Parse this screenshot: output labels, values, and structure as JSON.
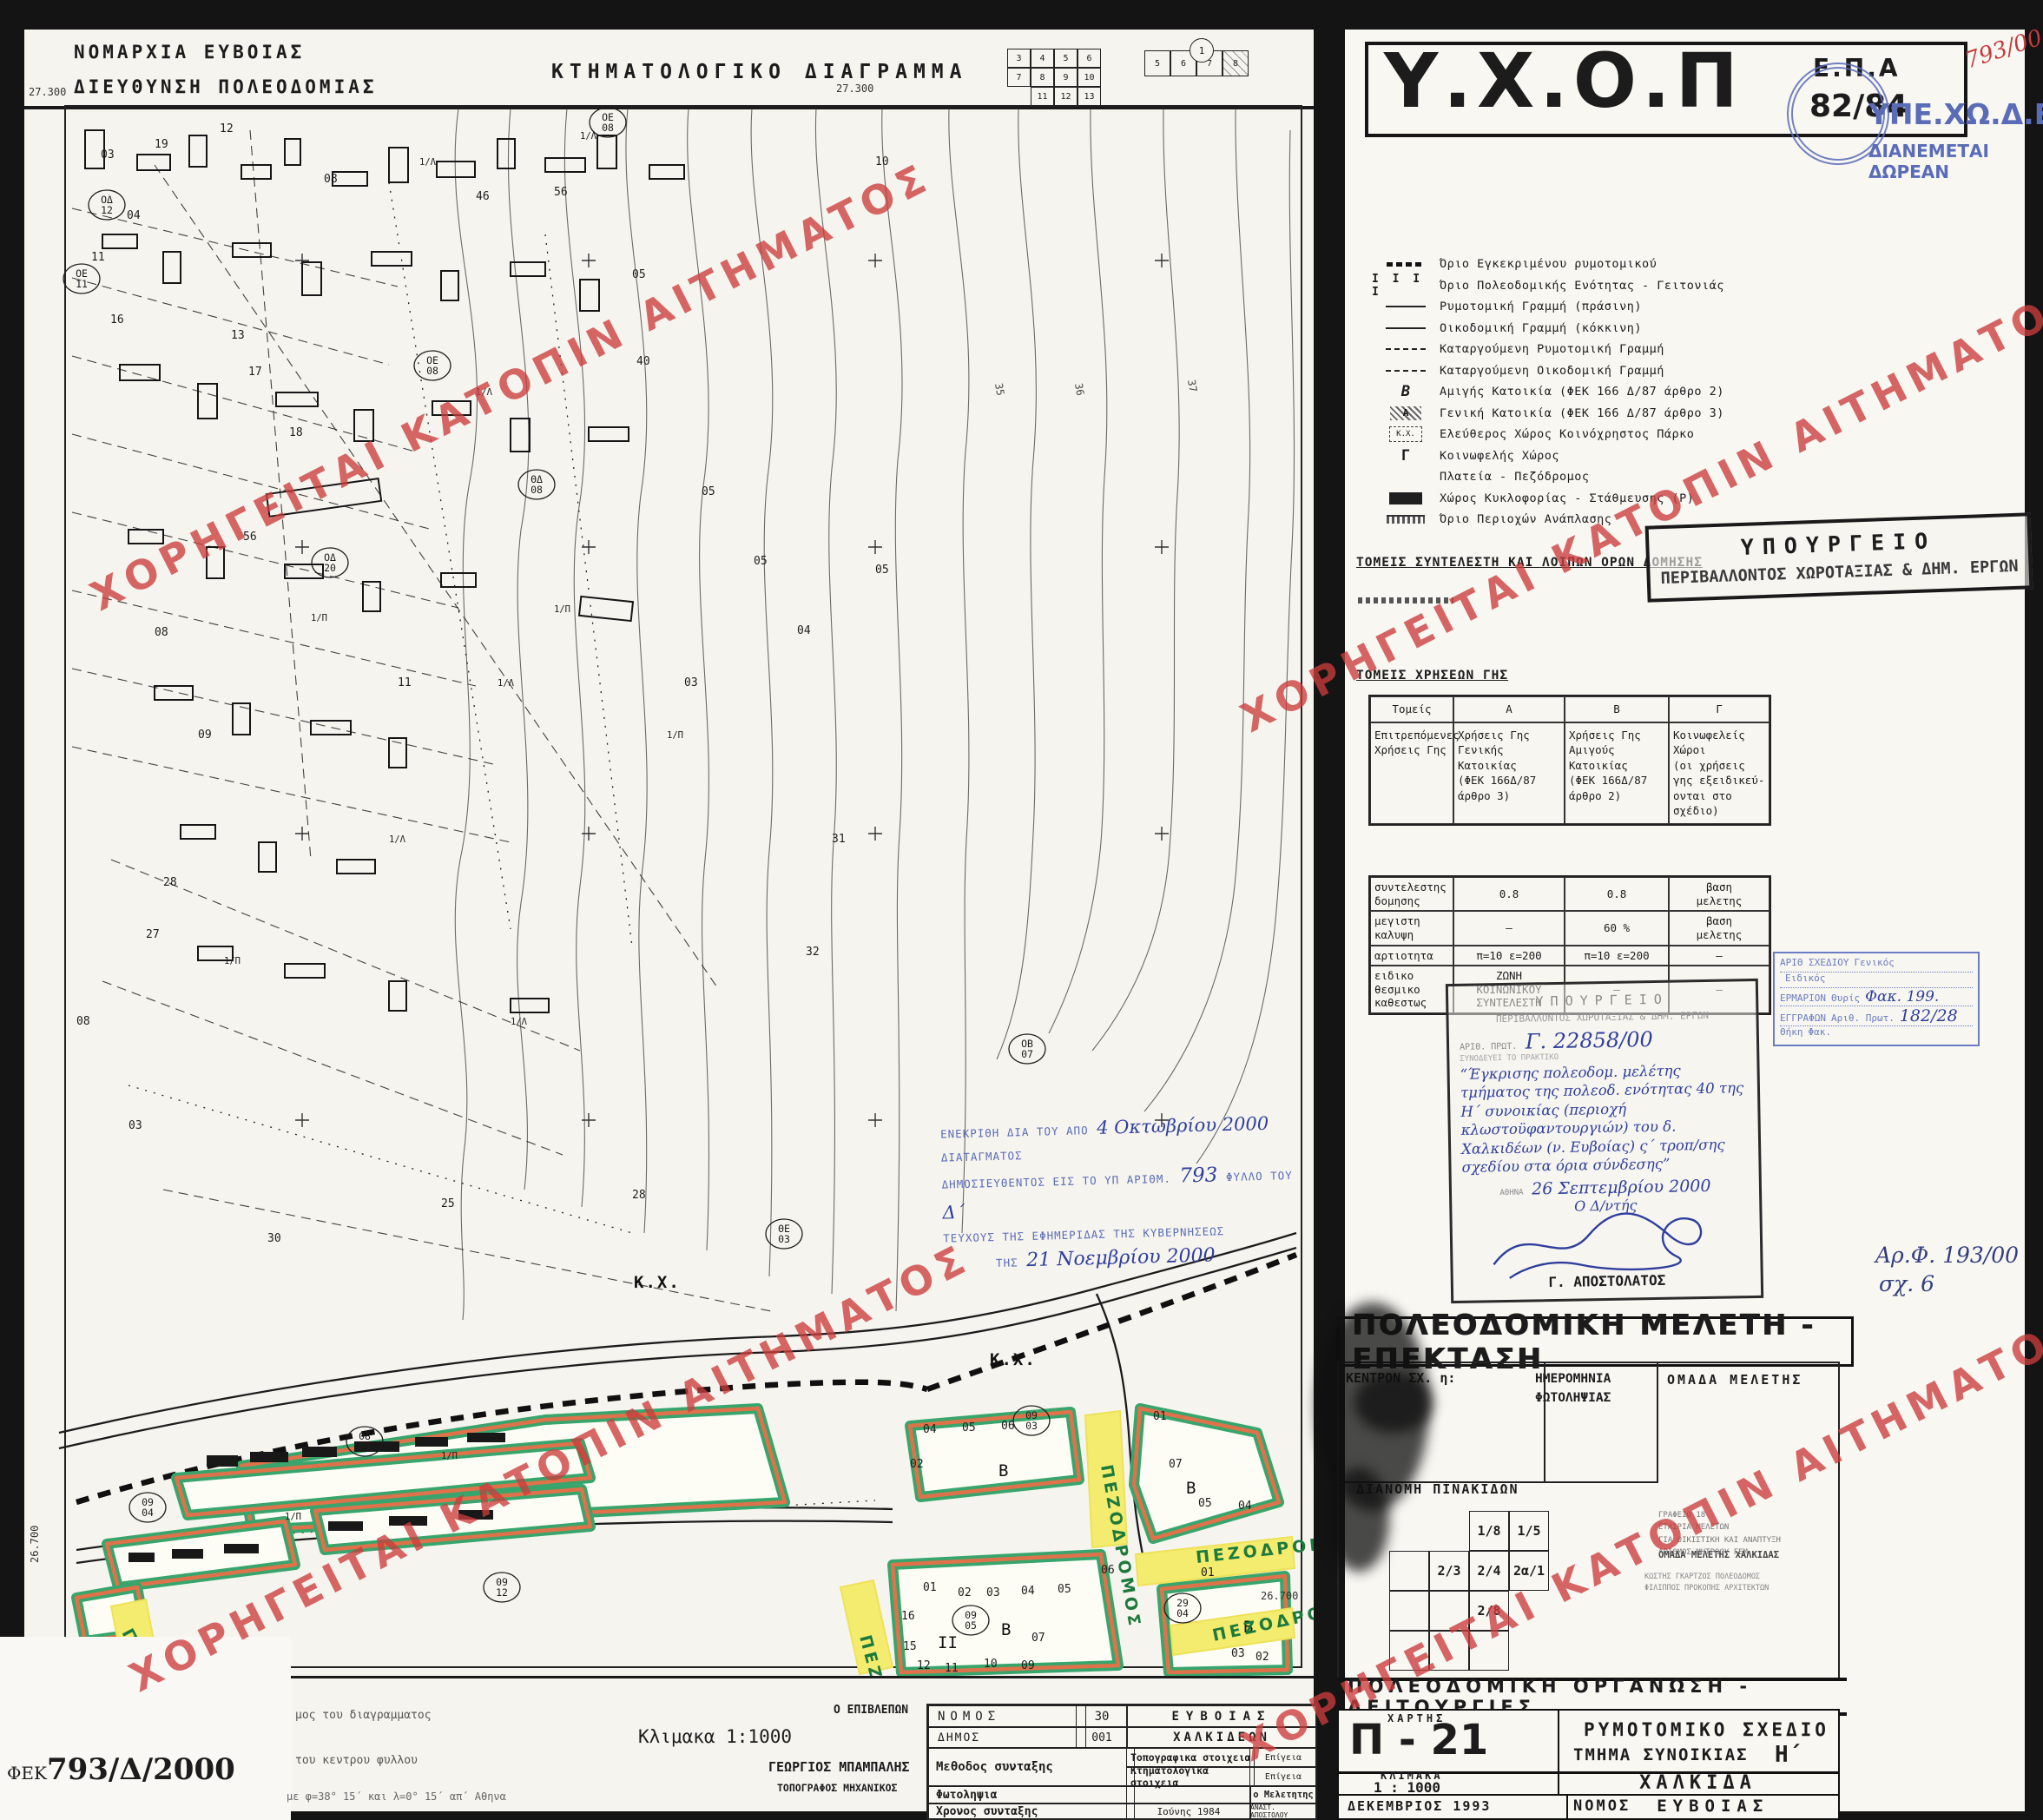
{
  "header": {
    "line1": "ΝΟΜΑΡΧΙΑ ΕΥΒΟΙΑΣ",
    "line2": "ΔΙΕΥΘΥΝΣΗ ΠΟΛΕΟΔΟΜΙΑΣ",
    "title": "ΚΤΗΜΑΤΟΛΟΓΙΚΟ ΔΙΑΓΡΑΜΜΑ"
  },
  "index_grids": {
    "left": [
      [
        "3",
        "4",
        "5",
        "6"
      ],
      [
        "7",
        "8",
        "9",
        "10"
      ],
      [
        "",
        "11",
        "12",
        "13"
      ]
    ],
    "right_top": "1",
    "right_row": [
      "5",
      "6",
      "7",
      "8"
    ]
  },
  "agency": {
    "name": "Υ.Χ.Ο.Π",
    "epa": "Ε.Π.Α",
    "code": "82/84",
    "dept": "ΥΠΕ.ΧΩ.Δ.Ε.",
    "free": "ΔΙΑΝΕΜΕΤΑΙ ΔΩΡΕΑΝ",
    "note_red": "793/00"
  },
  "legend": {
    "items": [
      "Όριο Εγκεκριμένου ρυμοτομικού",
      "Όριο Πολεοδομικής Ενότητας - Γειτονιάς",
      "Ρυμοτομική Γραμμή (πράσινη)",
      "Οικοδομική Γραμμή (κόκκινη)",
      "Καταργούμενη Ρυμοτομική Γραμμή",
      "Καταργούμενη Οικοδομική Γραμμή",
      "Αμιγής Κατοικία (ΦΕΚ 166 Δ/87 άρθρο 2)",
      "Γενική Κατοικία (ΦΕΚ 166 Δ/87 άρθρο 3)",
      "Ελεύθερος Χώρος Κοινόχρηστος   Πάρκο",
      "Κοινωφελής Χώρος",
      "Πλατεία - Πεζόδρομος",
      "Χώρος Κυκλοφορίας - Στάθμευσης (Ρ)",
      "Όριο Περιοχών Ανάπλασης"
    ]
  },
  "sections": {
    "coeff_heading": "ΤΟΜΕΙΣ ΣΥΝΤΕΛΕΣΤΗ ΚΑΙ ΛΟΙΠΩΝ ΟΡΩΝ ΔΟΜΗΣΗΣ",
    "landuse_heading": "ΤΟΜΕΙΣ ΧΡΗΣΕΩΝ ΓΗΣ"
  },
  "ministry_box": {
    "l1": "ΥΠΟΥΡΓΕΙΟ",
    "l2": "ΠΕΡΙΒΑΛΛΟΝΤΟΣ ΧΩΡΟΤΑΞΙΑΣ & ΔΗΜ. ΕΡΓΩΝ"
  },
  "landuse_table": {
    "headers": [
      "Τομείς",
      "Α",
      "Β",
      "Γ"
    ],
    "row_label": "Επιτρεπόμενες\nΧρήσεις Γης",
    "col_a": "Χρήσεις Γης\nΓενικής\nΚατοικίας\n(ΦΕΚ 166Δ/87\nάρθρο 3)",
    "col_b": "Χρήσεις Γης\nΑμιγούς\nΚατοικίας\n(ΦΕΚ 166Δ/87\nάρθρο 2)",
    "col_c": "Κοινωφελείς\nΧώροι\n(οι χρήσεις\nγης εξειδικεύ-\nονται στο σχέδιο)"
  },
  "coeff_table": {
    "rows": [
      {
        "label": "συντελεστης\nδομησης",
        "a": "0.8",
        "b": "0.8",
        "c": "βαση\nμελετης"
      },
      {
        "label": "μεγιστη\nκαλυψη",
        "a": "–",
        "b": "60 %",
        "c": "βαση\nμελετης"
      },
      {
        "label": "αρτιοτητα",
        "a": "π=10  ε=200",
        "b": "π=10  ε=200",
        "c": "—"
      },
      {
        "label": "ειδικο\nθεσμικο\nκαθεστως",
        "a": "ΖΩΝΗ\nΚΟΙΝΩΝΙΚΟΥ\nΣΥΝΤΕΛΕΣΤΗ",
        "b": "—",
        "c": "—"
      }
    ]
  },
  "approval_stamp": {
    "l1": "ΥΠΟΥΡΓΕΙΟ",
    "l2": "ΠΕΡΙΒΑΛΛΟΝΤΟΣ ΧΩΡΟΤΑΞΙΑΣ & ΔΗΜ. ΕΡΓΩΝ",
    "proto_label": "ΑΡΙΘ. ΠΡΩΤ.",
    "proto": "Γ. 22858/00",
    "attach_label": "ΣΥΝΟΔΕΥΕΙ ΤΟ ΠΡΑΚΤΙΚΟ",
    "subject": "“Έγκρισης πολεοδομ. μελέτης τμήματος της πολεοδ. ενότητας 40 της Η΄ συνοικίας (περιοχή κλωστοϋφαντουργιών) του δ. Χαλκιδέων (ν. Ευβοίας) ς΄ τροπ/σης σχεδίου στα όρια σύνδεσης”",
    "place": "ΑΘΗΝΑ",
    "date": "26 Σεπτεμβρίου 2000",
    "role": "Ο Δ/ντής",
    "signer": "Γ. ΑΠΟΣΤΟΛΑΤΟΣ"
  },
  "archive_stamp": {
    "r1l": "ΑΡΙΘ ΣΧΕΔΙΟΥ",
    "r1a": "Γενικός",
    "r1b": "Ειδικός",
    "r2l": "ΕΡΜΑΡΙΟΝ",
    "r2a": "Θυρίς",
    "r2b": "Φακ. 199.",
    "r3l": "ΕΓΓΡΑΦΩΝ",
    "r3a": "Αριθ. Πρωτ.",
    "r3b": "182/28",
    "r4a": "Θήκη",
    "r4b": "Φακ."
  },
  "file_note": {
    "l1": "Αρ.Φ. 193/00",
    "l2": "σχ. 6"
  },
  "study": {
    "title": "ΠΟΛΕΟΔΟΜΙΚΗ ΜΕΛΕΤΗ - ΕΠΕΚΤΑΣΗ",
    "c1": "ΚΕΝΤΡΟΝ ΣΧ. η:",
    "c2": "ΗΜΕΡΟΜΗΝΙΑ ΦΩΤΟΛΗΨΙΑΣ",
    "c3": "ΟΜΑΔΑ ΜΕΛΕΤΗΣ",
    "dist": "ΔΙΑΝΟΜΗ ΠΙΝΑΚΙΔΩΝ",
    "grid": [
      "1/8",
      "1/5",
      "2/3",
      "2/4",
      "2α/1",
      "2/8"
    ],
    "team": "ΟΜΑΔΑ ΜΕΛΕΤΗΣ ΧΑΛΚΙΔΑΣ",
    "firm": "ΓΡΑΦΕΙΟ 18\nΕΤΑΙΡΙΑ ΜΕΛΕΤΩΝ\nΓΙΑ ΟΙΚΙΣΤΙΚΗ ΚΑΙ ΑΝΑΠΤΥΞΗ\nΑΡΙΘΜΟΣ ΜΗΤΡΩΟΥ ΓΕΜ",
    "names": "ΚΩΣΤΗΣ ΓΚΑΡΤΖΟΣ   ΠΟΛΕΟΔΟΜΟΣ\nΦΙΛΙΠΠΟΣ ΠΡΟΚΟΠΗΣ   ΑΡΧΙΤΕΚΤΩΝ"
  },
  "org_bar": "ΠΟΛΕΟΔΟΜΙΚΗ ΟΡΓΑΝΩΣΗ - ΛΕΙΤΟΥΡΓΙΕΣ",
  "titleblock": {
    "map_label": "ΧΑΡΤΗΣ",
    "code": "Π - 21",
    "plan1": "ΡΥΜΟΤΟΜΙΚΟ ΣΧΕΔΙΟ",
    "plan2": "ΤΜΗΜΑ ΣΥΝΟΙΚΙΑΣ",
    "plan2v": "Η΄",
    "scale_label": "ΚΛΙΜΑΚΑ",
    "scale": "1 : 1000",
    "city": "ΧΑΛΚΙΔΑ",
    "date": "ΔΕΚΕΜΒΡΙΟΣ 1993",
    "nomos_label": "ΝΟΜΟΣ",
    "nomos": "ΕΥΒΟΙΑΣ"
  },
  "corner": {
    "sheet": "Β4",
    "fek_label": "ΦΕΚ",
    "fek": "793/Δ/2000",
    "note1": "μος του διαγραμματος",
    "note2": "του κεντρου φυλλου",
    "note3": "με φ=38° 15΄ και λ=0° 15΄ απ΄ Αθηνα"
  },
  "supervisor": {
    "scale_note": "Κλιμακα  1:1000",
    "label": "Ο ΕΠΙΒΛΕΠΩΝ",
    "name": "ΓΕΩΡΓΙΟΣ  ΜΠΑΜΠΑΛΗΣ",
    "title": "ΤΟΠΟΓΡΑΦΟΣ  ΜΗΧΑΝΙΚΟΣ"
  },
  "survey": {
    "nomos_label": "ΝΟΜΟΣ",
    "nomos_code": "30",
    "nomos": "ΕΥΒΟΙΑΣ",
    "dimos_label": "ΔΗΜΟΣ",
    "dimos_code": "001",
    "dimos": "ΧΑΛΚΙΔΕΩΝ",
    "method_label": "Μεθοδος συνταξης",
    "topo_label": "Τοπογραφικα στοιχεια",
    "topo_val": "Επίγεια",
    "ktim_label": "Κτηματολογικα στοιχεια",
    "ktim_val": "Επίγεια",
    "photo_label": "Φωτοληψια",
    "meletitis": "ο Μελετητης",
    "time_label": "Χρονος συνταξης",
    "time_val": "Ιούνης  1984",
    "meletitis_name": "ΑΝΑΣΤ. ΑΠΟΣΤΟΛΟΥ"
  },
  "map": {
    "watermark": "ΧΟΡΗΓΕΙΤΑΙ ΚΑΤΟΠΙΝ ΑΙΤΗΜΑΤΟΣ",
    "stamp": {
      "p1": "ΕΝΕΚΡΙΘΗ ΔΙΑ ΤΟΥ ΑΠΟ",
      "h1": "4 Οκτωβρίου 2000",
      "p2": "ΔΙΑΤΑΓΜΑΤΟΣ",
      "p3": "ΔΗΜΟΣΙΕΥΘΕΝΤΟΣ ΕΙΣ ΤΟ ΥΠ ΑΡΙΘΜ.",
      "h2": "793",
      "p4": "ΦΥΛΛΟ ΤΟΥ",
      "h3": "Δ΄",
      "p5": "ΤΕΥΧΟΥΣ ΤΗΣ ΕΦΗΜΕΡΙΔΑΣ ΤΗΣ ΚΥΒΕΡΝΗΣΕΩΣ",
      "p6": "ΤΗΣ",
      "h4": "21 Νοεμβρίου 2000"
    },
    "labels": [
      [
        5,
        20,
        "27.300",
        "o",
        0
      ],
      [
        935,
        16,
        "27.300",
        "o",
        0
      ],
      [
        1424,
        1752,
        "26.700",
        "o",
        0
      ],
      [
        16,
        1710,
        "26.700",
        "o",
        -90
      ],
      [
        1118,
        352,
        "35",
        "t",
        80
      ],
      [
        1210,
        352,
        "36",
        "t",
        80
      ],
      [
        1340,
        348,
        "37",
        "t",
        80
      ],
      [
        1112,
        1482,
        "Κ.Χ.",
        "k",
        0
      ],
      [
        702,
        1393,
        "Κ.Χ.",
        "k",
        0
      ],
      [
        1122,
        1610,
        "Β",
        "B",
        0
      ],
      [
        1338,
        1630,
        "Β",
        "B",
        0
      ],
      [
        1125,
        1793,
        "Β",
        "B",
        0
      ],
      [
        1404,
        1790,
        "Β",
        "B",
        0
      ],
      [
        1052,
        1808,
        "II",
        "B",
        0
      ],
      [
        1240,
        1598,
        "ΠΕΖΟΔΡΟΜΟΣ",
        "p",
        80
      ],
      [
        1350,
        1710,
        "ΠΕΖΟΔΡΟΜΟΣ",
        "p",
        -6
      ],
      [
        962,
        1795,
        "ΠΕΖΟΔΡΟΜΟΣ",
        "p",
        75
      ],
      [
        1370,
        1800,
        "ΠΕΖΟΔΡΟΜΟΣ",
        "p",
        -12
      ],
      [
        112,
        1790,
        "ΠΕΖΟΔΡΟΜΟΣ",
        "p",
        62
      ],
      [
        95,
        150,
        "ΟΔ|12",
        "c",
        0
      ],
      [
        66,
        235,
        "ΟΕ|11",
        "c",
        0
      ],
      [
        352,
        562,
        "ΟΔ|20",
        "c",
        0
      ],
      [
        470,
        335,
        "ΟΕ|08",
        "c",
        0
      ],
      [
        672,
        55,
        "ΟΕ|08",
        "c",
        0
      ],
      [
        590,
        472,
        "ΘΔ|08",
        "c",
        0
      ],
      [
        1155,
        1122,
        "ΟΒ|07",
        "c",
        0
      ],
      [
        875,
        1335,
        "ΘΕ|03",
        "c",
        0
      ],
      [
        142,
        1650,
        "09|04",
        "c",
        0
      ],
      [
        392,
        1574,
        "08|03",
        "c",
        0
      ],
      [
        1160,
        1550,
        "09|03",
        "c",
        0
      ],
      [
        1090,
        1780,
        "09|05",
        "c",
        0
      ],
      [
        1334,
        1766,
        "29|04",
        "c",
        0
      ],
      [
        550,
        1742,
        "09|12",
        "c",
        0
      ],
      [
        88,
        92,
        "03",
        "n",
        0
      ],
      [
        150,
        80,
        "19",
        "n",
        0
      ],
      [
        225,
        62,
        "12",
        "n",
        0
      ],
      [
        118,
        162,
        "04",
        "n",
        0
      ],
      [
        77,
        210,
        "11",
        "n",
        0
      ],
      [
        99,
        282,
        "16",
        "n",
        0
      ],
      [
        238,
        300,
        "13",
        "n",
        0
      ],
      [
        258,
        342,
        "17",
        "n",
        0
      ],
      [
        305,
        412,
        "18",
        "n",
        0
      ],
      [
        252,
        532,
        "56",
        "n",
        0
      ],
      [
        150,
        642,
        "08",
        "n",
        0
      ],
      [
        345,
        120,
        "08",
        "n",
        0
      ],
      [
        520,
        140,
        "46",
        "n",
        0
      ],
      [
        610,
        135,
        "56",
        "n",
        0
      ],
      [
        700,
        230,
        "05",
        "n",
        0
      ],
      [
        780,
        480,
        "05",
        "n",
        0
      ],
      [
        840,
        560,
        "05",
        "n",
        0
      ],
      [
        430,
        700,
        "11",
        "n",
        0
      ],
      [
        200,
        760,
        "09",
        "n",
        0
      ],
      [
        160,
        930,
        "28",
        "n",
        0
      ],
      [
        140,
        990,
        "27",
        "n",
        0
      ],
      [
        760,
        700,
        "03",
        "n",
        0
      ],
      [
        890,
        640,
        "04",
        "n",
        0
      ],
      [
        980,
        100,
        "10",
        "n",
        0
      ],
      [
        705,
        330,
        "40",
        "n",
        0
      ],
      [
        980,
        570,
        "05",
        "n",
        0
      ],
      [
        60,
        1090,
        "08",
        "n",
        0
      ],
      [
        120,
        1210,
        "03",
        "n",
        0
      ],
      [
        280,
        1340,
        "30",
        "n",
        0
      ],
      [
        480,
        1300,
        "25",
        "n",
        0
      ],
      [
        700,
        1290,
        "28",
        "n",
        0
      ],
      [
        900,
        1010,
        "32",
        "n",
        0
      ],
      [
        930,
        880,
        "31",
        "n",
        0
      ],
      [
        1035,
        1560,
        "04",
        "n",
        0
      ],
      [
        1080,
        1558,
        "05",
        "n",
        0
      ],
      [
        1125,
        1556,
        "06",
        "n",
        0
      ],
      [
        1020,
        1600,
        "02",
        "n",
        0
      ],
      [
        1300,
        1545,
        "01",
        "n",
        0
      ],
      [
        1318,
        1600,
        "07",
        "n",
        0
      ],
      [
        1352,
        1645,
        "05",
        "n",
        0
      ],
      [
        1398,
        1648,
        "04",
        "n",
        0
      ],
      [
        1035,
        1742,
        "01",
        "n",
        0
      ],
      [
        1075,
        1748,
        "02",
        "n",
        0
      ],
      [
        1108,
        1748,
        "03",
        "n",
        0
      ],
      [
        1148,
        1746,
        "04",
        "n",
        0
      ],
      [
        1190,
        1744,
        "05",
        "n",
        0
      ],
      [
        1240,
        1722,
        "06",
        "n",
        0
      ],
      [
        1010,
        1775,
        "16",
        "n",
        0
      ],
      [
        1012,
        1810,
        "15",
        "n",
        0
      ],
      [
        1160,
        1800,
        "07",
        "n",
        0
      ],
      [
        1148,
        1832,
        "09",
        "n",
        0
      ],
      [
        1105,
        1830,
        "10",
        "n",
        0
      ],
      [
        1060,
        1835,
        "11",
        "n",
        0
      ],
      [
        1028,
        1832,
        "12",
        "n",
        0
      ],
      [
        1355,
        1725,
        "01",
        "n",
        0
      ],
      [
        1390,
        1818,
        "03",
        "n",
        0
      ],
      [
        1418,
        1822,
        "02",
        "n",
        0
      ],
      [
        455,
        100,
        "1/Λ",
        "b",
        0
      ],
      [
        640,
        70,
        "1/Λ",
        "b",
        0
      ],
      [
        520,
        365,
        "1/Λ",
        "b",
        0
      ],
      [
        330,
        625,
        "1/Π",
        "b",
        0
      ],
      [
        610,
        615,
        "1/Π",
        "b",
        0
      ],
      [
        545,
        700,
        "1/Λ",
        "b",
        0
      ],
      [
        740,
        760,
        "1/Π",
        "b",
        0
      ],
      [
        420,
        880,
        "1/Λ",
        "b",
        0
      ],
      [
        230,
        1020,
        "1/Π",
        "b",
        0
      ],
      [
        560,
        1090,
        "1/Λ",
        "b",
        0
      ],
      [
        480,
        1590,
        "1/Π",
        "b",
        0
      ],
      [
        300,
        1660,
        "1/Π",
        "b",
        0
      ]
    ]
  }
}
